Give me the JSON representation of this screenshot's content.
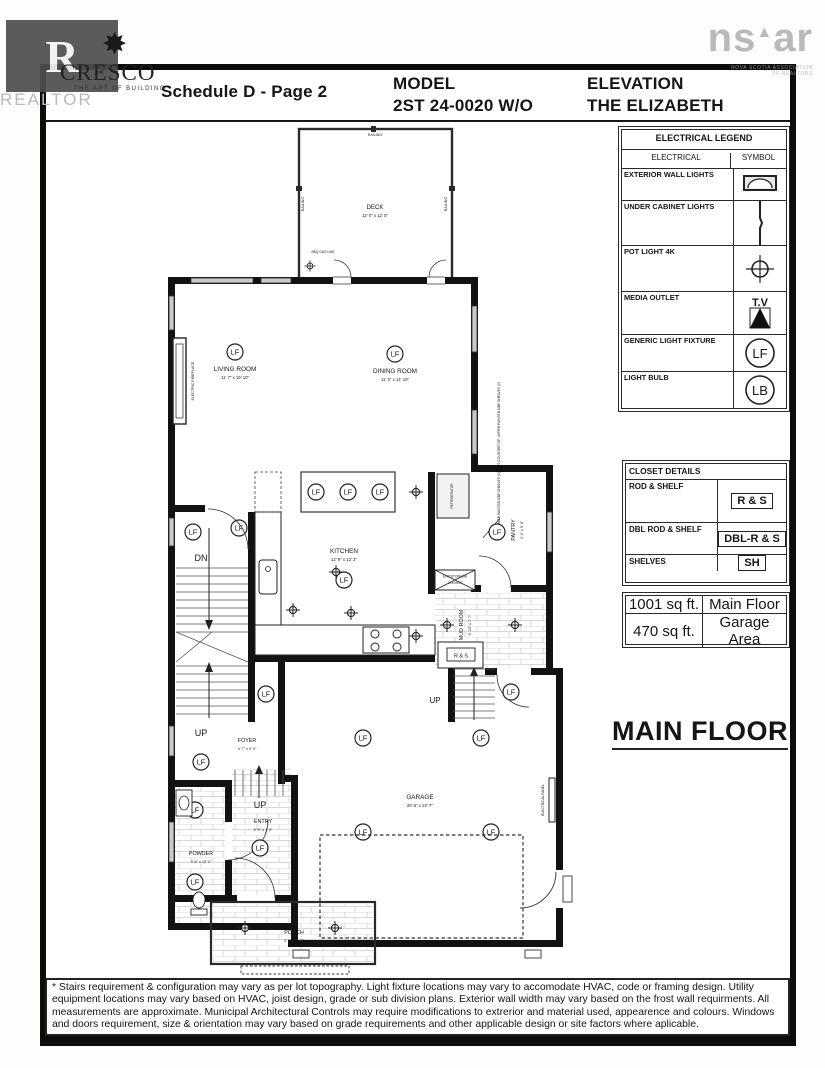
{
  "header": {
    "schedule": "Schedule D - Page 2",
    "model_label": "MODEL",
    "model_value": "2ST 24-0020 W/O",
    "elevation_label": "ELEVATION",
    "elevation_value": "THE ELIZABETH",
    "cresco": {
      "star": "✸",
      "name": "CRESCO",
      "tagline": "THE ART OF BUILDING"
    },
    "realtor_tile": "R",
    "realtor_watermark": "REALTOR",
    "nsar": {
      "word_left": "ns",
      "caret": "▲",
      "word_right": "ar",
      "caption1": "NOVA SCOTIA ASSOCIATION",
      "caption2": "OF REALTORS"
    }
  },
  "electrical_legend": {
    "title": "ELECTRICAL LEGEND",
    "col_electrical": "ELECTRICAL",
    "col_symbol": "SYMBOL",
    "rows": [
      {
        "label": "EXTERIOR WALL LIGHTS",
        "symbol": "exterior-wall-light"
      },
      {
        "label": "UNDER CABINET LIGHTS",
        "symbol": "under-cabinet-light"
      },
      {
        "label": "POT LIGHT 4K",
        "symbol": "pot-light"
      },
      {
        "label": "MEDIA OUTLET",
        "symbol": "media-outlet",
        "symbol_text": "T.V"
      },
      {
        "label": "GENERIC LIGHT FIXTURE",
        "symbol": "circle",
        "symbol_text": "LF"
      },
      {
        "label": "LIGHT BULB",
        "symbol": "circle",
        "symbol_text": "LB"
      }
    ]
  },
  "closet_details": {
    "title": "CLOSET DETAILS",
    "rows": [
      {
        "label": "ROD & SHELF",
        "tag": "R & S"
      },
      {
        "label": "DBL ROD & SHELF",
        "tag": "DBL-R & S"
      },
      {
        "label": "SHELVES",
        "tag": "SH"
      }
    ]
  },
  "area_table": {
    "rows": [
      {
        "value": "1001 sq ft.",
        "name": "Main Floor"
      },
      {
        "value": "470 sq ft.",
        "name": "Garage Area"
      }
    ]
  },
  "floor_title": "MAIN FLOOR",
  "plan": {
    "lf": "LF",
    "deck": {
      "name": "DECK",
      "dims": "12' 0\" x 12' 0\""
    },
    "railing": "RAILING",
    "bbq_note": "BBQ GAS LINE",
    "living": {
      "name": "LIVING ROOM",
      "dims": "11' 7\" x 19' 10\""
    },
    "dining": {
      "name": "DINING ROOM",
      "dims": "11' 5\" x 14' 10\""
    },
    "electric_fireplace": "ELECTRIC FIREPLACE",
    "kitchen": {
      "name": "KITCHEN",
      "dims": "12' 9\" x 12' 2\""
    },
    "refrigerator": "REFRIGERATOR",
    "shelf_note": "LOWER PAINTED MDF SHELVES (3) PLUS COUNTERTOP, UPPER PAINTED MDF SHELVES (2)",
    "pantry": {
      "name": "PANTRY",
      "dims": "4' 4\" x 5' 6\""
    },
    "mud_room": {
      "name": "MUD ROOM",
      "dims": "5' 10\" x 7' 7\""
    },
    "locker_line1": "ENT/STORAGE",
    "locker_line2": "LOCKER",
    "rs": "R & S",
    "dn": "DN",
    "up": "UP",
    "foyer": {
      "name": "FOYER",
      "dims": "4' 7\" x 9' 0\""
    },
    "powder": {
      "name": "POWDER",
      "dims": "3' 6\" x 10' 2\""
    },
    "entry": {
      "name": "ENTRY",
      "dims": "5' 5\" x 7' 9\""
    },
    "garage": {
      "name": "GARAGE",
      "dims": "20' 6\" x 22' 7\""
    },
    "electrical_panel": "ELECTRICAL PANEL",
    "porch": {
      "name": "PORCH",
      "dims": "4' 7\" x 5' 11\""
    }
  },
  "footer": {
    "disclaimer": "* Stairs requirement & configuration may vary as per lot topography. Light fixture locations may vary to accomodate HVAC, code or framing design. Utility equipment locations may vary based on HVAC, joist design, grade or sub division plans. Exterior wall width may vary based on the frost wall requirments. All measurements are approximate. Municipal Architectural Controls may require modifications to extrerior and material used, appearence and colours. Windows and doors requirement, size & orientation may vary based on grade requirements and other applicable design or site factors where aplicable."
  }
}
